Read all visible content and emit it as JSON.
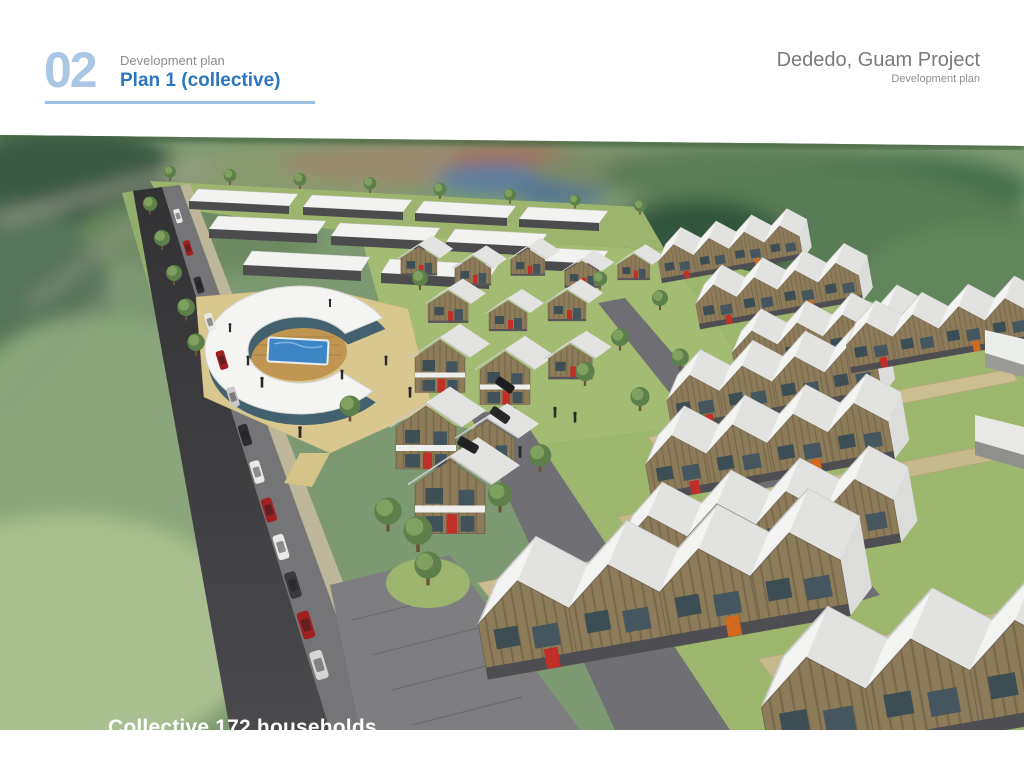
{
  "header": {
    "section_number": "02",
    "section_label": "Development plan",
    "section_title": "Plan 1 (collective)"
  },
  "project": {
    "title": "Dededo, Guam Project",
    "subtitle": "Development plan"
  },
  "rendering": {
    "caption": "Collective 172 households"
  },
  "colors": {
    "section_number_blue": "#a9c7e5",
    "section_title_blue": "#2b76bd",
    "underline_blue": "#9cc0e2",
    "label_gray": "#8c8c8c",
    "project_gray": "#7a7a7a",
    "caption_white": "#ffffff",
    "roof_white": "#f3f3f1",
    "facade_wood": "#8d7c5a",
    "window_dark": "#3e4e55",
    "door_red": "#c03028",
    "accent_orange": "#d2691e",
    "road_dark": "#3b3b3d",
    "pool_blue": "#3f86c6",
    "lawn_green": "#a3bb72",
    "plaza_tan": "#d8c88f"
  }
}
